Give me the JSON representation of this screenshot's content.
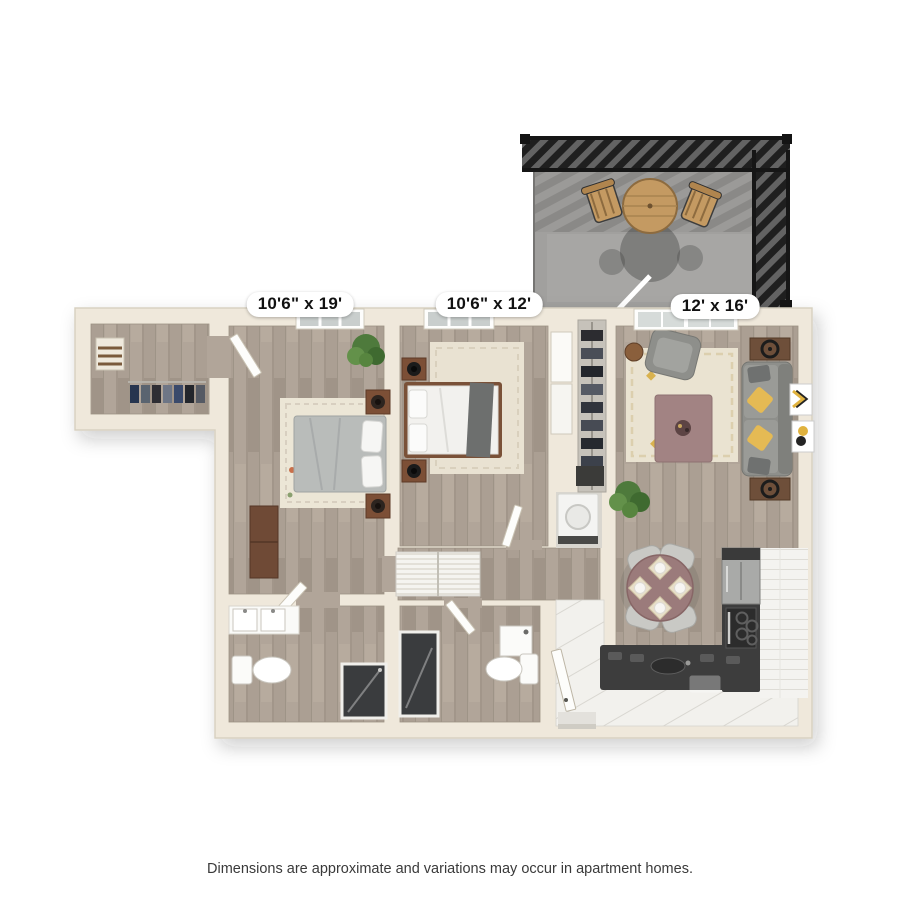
{
  "page": {
    "background_color": "#ffffff",
    "disclaimer": "Dimensions are approximate and variations may occur in apartment homes."
  },
  "floorplan": {
    "type": "apartment-floor-plan-3d-top-view",
    "dimension_labels": [
      {
        "room": "bedroom-1",
        "text": "10'6\" x 19'"
      },
      {
        "room": "bedroom-2",
        "text": "10'6\" x 12'"
      },
      {
        "room": "living-room",
        "text": "12' x 16'"
      }
    ],
    "rooms": [
      {
        "name": "balcony",
        "features": [
          "pergola-railing",
          "round-bistro-table",
          "two-wood-chairs"
        ]
      },
      {
        "name": "bedroom-1",
        "features": [
          "bed-gray-duvet",
          "patterned-rug",
          "dresser",
          "two-nightstands-with-lamps",
          "plant",
          "window"
        ]
      },
      {
        "name": "bedroom-2",
        "features": [
          "bed-white-duvet-gray-throw",
          "rug",
          "two-nightstands-with-lamps",
          "sliding-door-closet",
          "window"
        ]
      },
      {
        "name": "living-room",
        "features": [
          "gray-sofa-yellow-pillows",
          "accent-chair",
          "mauve-coffee-table",
          "rug",
          "two-wall-art-frames",
          "plant",
          "sliding-glass-door"
        ]
      },
      {
        "name": "dining-area",
        "features": [
          "round-mauve-table",
          "four-gray-chairs",
          "four-place-settings"
        ]
      },
      {
        "name": "kitchen",
        "features": [
          "refrigerator",
          "range-with-burners",
          "l-shaped-dark-counter",
          "sink",
          "white-plank-tile-floor",
          "brick-backsplash"
        ]
      },
      {
        "name": "bathroom-1",
        "features": [
          "vanity-sinks",
          "toilet",
          "dark-walk-in-shower"
        ]
      },
      {
        "name": "bathroom-2",
        "features": [
          "vanity-sink",
          "toilet",
          "dark-walk-in-shower",
          "entry-door"
        ]
      },
      {
        "name": "walk-in-closet",
        "features": [
          "hanging-clothes",
          "shelves"
        ]
      },
      {
        "name": "hallway",
        "features": [
          "louvered-linen-closet",
          "washer-closet"
        ]
      }
    ],
    "colors": {
      "wall": "#efe8db",
      "wall_edge": "#d8d1c1",
      "wood_floor": "#ab9f93",
      "balcony_floor": "#a1a09e",
      "railing": "#262626",
      "kitchen_counter": "#3d3d3d",
      "kitchen_floor": "#f2f1ed",
      "sofa": "#8e8f8b",
      "accent_pillow": "#e5ba54",
      "coffee_table": "#a28383",
      "dining_table": "#9b7b7b",
      "rug": "#eae3d1",
      "label_bg": "#ffffff",
      "label_text": "#111111",
      "disclaimer_text": "#3a3a3a"
    }
  }
}
